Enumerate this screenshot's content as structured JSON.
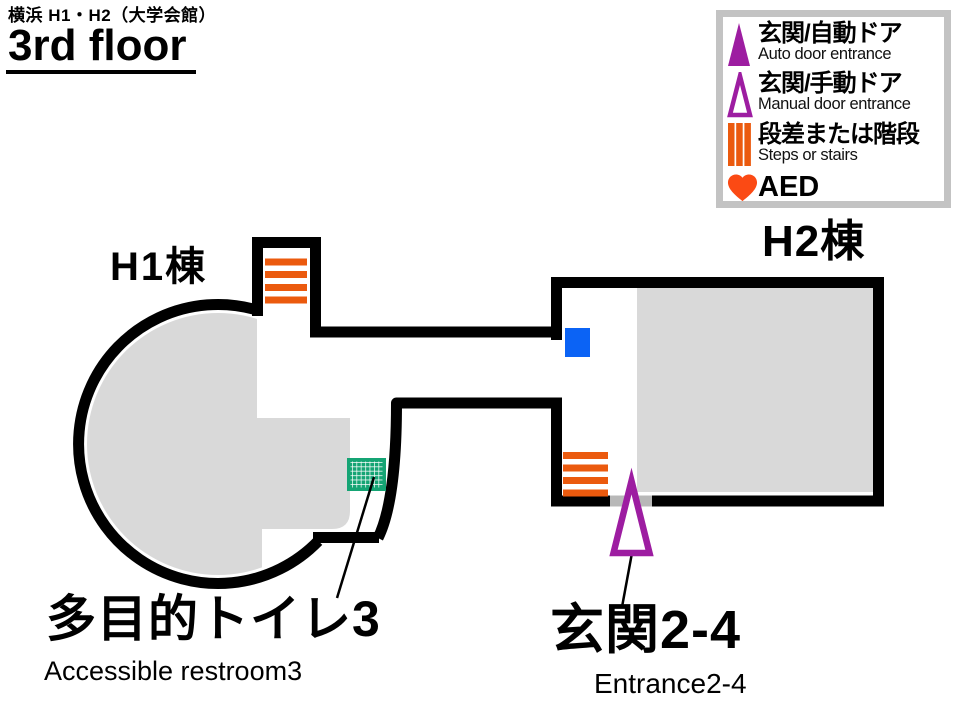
{
  "header": {
    "area_title": "横浜 H1・H2（大学会館）",
    "floor_title": "3rd floor"
  },
  "legend": {
    "items": [
      {
        "icon": "auto-door-triangle-filled-icon",
        "label_jp": "玄関/自動ドア",
        "label_en": "Auto door entrance"
      },
      {
        "icon": "manual-door-triangle-outline-icon",
        "label_jp": "玄関/手動ドア",
        "label_en": "Manual door entrance"
      },
      {
        "icon": "steps-bars-icon",
        "label_jp": "段差または階段",
        "label_en": "Steps or stairs"
      },
      {
        "icon": "aed-heart-icon",
        "label_jp": "AED"
      }
    ]
  },
  "map": {
    "building_labels": [
      {
        "id": "h1",
        "label": "H1棟"
      },
      {
        "id": "h2",
        "label": "H2棟"
      }
    ],
    "callouts": [
      {
        "id": "accessible-restroom-3",
        "label_jp": "多目的トイレ3",
        "label_en": "Accessible restroom3",
        "marker": "green-grid-square"
      },
      {
        "id": "entrance-2-4",
        "label_jp": "玄関2-4",
        "label_en": "Entrance2-4",
        "marker": "manual-door-triangle"
      }
    ],
    "markers": [
      "stairs-marker-h1-corridor",
      "stairs-marker-h2",
      "blue-square-marker",
      "door-gap",
      "accessible-restroom-marker",
      "manual-door-entrance-triangle"
    ]
  },
  "colors": {
    "wall_black": "#000000",
    "room_fill_gray": "#d9d9d9",
    "stairs_orange": "#eb5a0e",
    "entrance_purple": "#9d1da1",
    "aed_heart_orange": "#fb4a14",
    "marker_blue": "#0b63f5",
    "restroom_green": "#15a474",
    "door_gap_gray": "#b8b8b8",
    "legend_border_gray": "#c3c3c3"
  }
}
